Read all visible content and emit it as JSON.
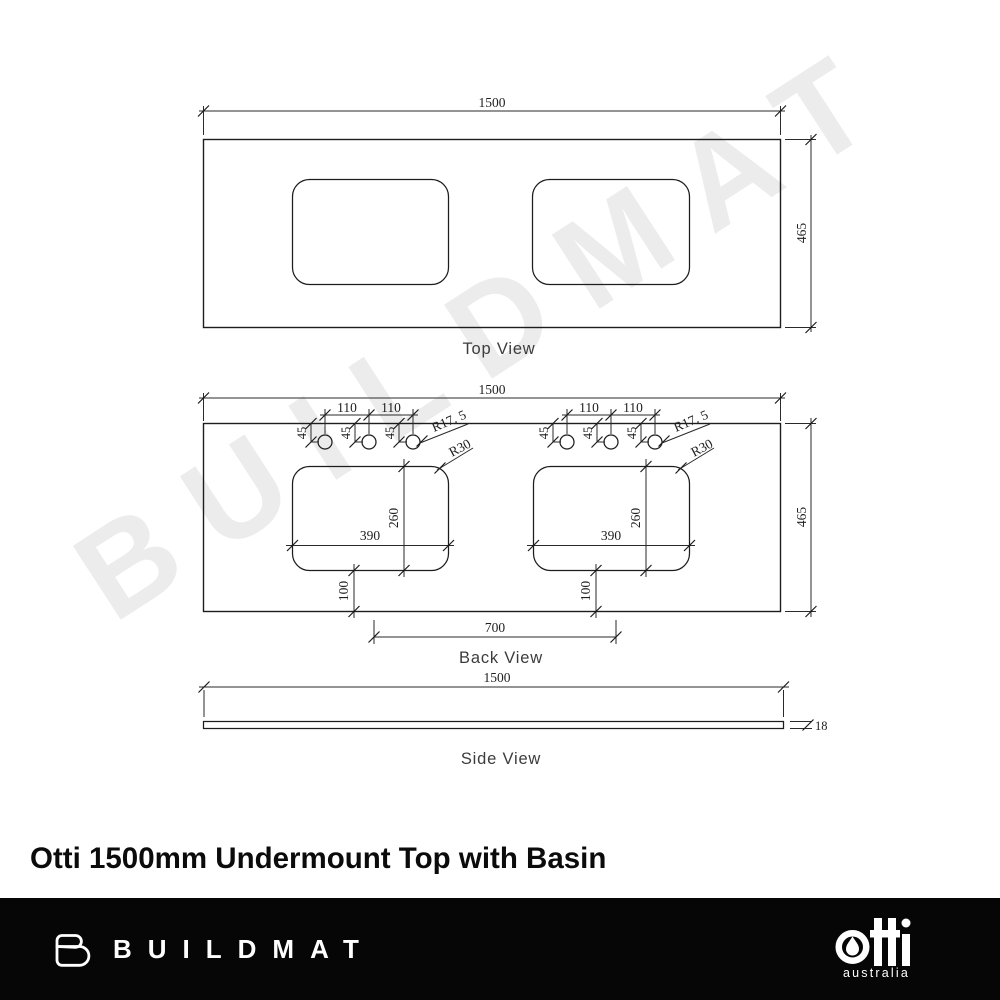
{
  "watermark": {
    "text": "BUILDMAT"
  },
  "title": "Otti 1500mm Undermount Top with Basin",
  "drawing": {
    "top_view": {
      "label": "Top View",
      "width": "1500",
      "depth": "465"
    },
    "back_view": {
      "label": "Back View",
      "width": "1500",
      "depth": "465",
      "hole_spacing": "110",
      "hole_inset": "45",
      "hole_radius": "R17. 5",
      "corner_radius": "R30",
      "cutout_width": "390",
      "cutout_depth": "260",
      "cutout_bottom_offset": "100",
      "cutout_centres": "700"
    },
    "side_view": {
      "label": "Side View",
      "width": "1500",
      "thickness": "18"
    }
  },
  "footer": {
    "buildmat_wordmark": "BUILDMAT",
    "otti_wordmark": "otti",
    "otti_tagline": "australia"
  }
}
